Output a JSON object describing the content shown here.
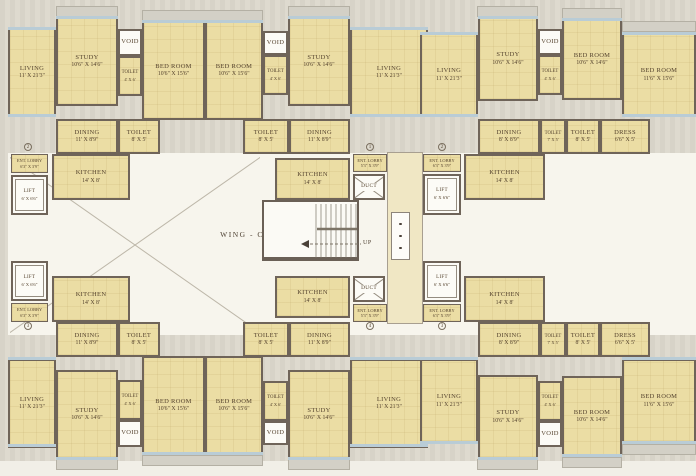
{
  "plan": {
    "wing_label": "WING - C",
    "stairs": {
      "up_label": "UP"
    },
    "colors": {
      "room_fill": "#ebdda4",
      "wall": "#6f6459",
      "window": "#b9ccd6",
      "open_area": "#f7f5ed",
      "background": "#d7d3c8",
      "text": "#55432e"
    },
    "flat_numbers": [
      {
        "value": "2",
        "x": 28,
        "y": 147
      },
      {
        "value": "1",
        "x": 370,
        "y": 147
      },
      {
        "value": "2",
        "x": 442,
        "y": 147
      },
      {
        "value": "3",
        "x": 28,
        "y": 326
      },
      {
        "value": "4",
        "x": 370,
        "y": 326
      },
      {
        "value": "3",
        "x": 442,
        "y": 326
      }
    ],
    "rooms": [
      {
        "kind": "hall",
        "x": 387,
        "y": 152,
        "w": 36,
        "h": 172
      },
      {
        "name": "LIVING",
        "dims": "11' X 21'3\"",
        "x": 8,
        "y": 28,
        "w": 48,
        "h": 89
      },
      {
        "name": "STUDY",
        "dims": "10'6\" X 14'6\"",
        "x": 56,
        "y": 17,
        "w": 62,
        "h": 89
      },
      {
        "name": "VOID",
        "x": 118,
        "y": 29,
        "w": 24,
        "h": 27,
        "kind": "shaft"
      },
      {
        "name": "TOILET",
        "dims": "4' X 6'",
        "x": 118,
        "y": 56,
        "w": 24,
        "h": 40
      },
      {
        "name": "BED ROOM",
        "dims": "10'6\" X 15'6\"",
        "x": 142,
        "y": 21,
        "w": 63,
        "h": 99
      },
      {
        "name": "BED ROOM",
        "dims": "10'6\" X 15'6\"",
        "x": 205,
        "y": 21,
        "w": 58,
        "h": 99
      },
      {
        "name": "VOID",
        "x": 263,
        "y": 31,
        "w": 25,
        "h": 24,
        "kind": "shaft"
      },
      {
        "name": "TOILET",
        "dims": "4' X 6'",
        "x": 263,
        "y": 55,
        "w": 25,
        "h": 40
      },
      {
        "name": "STUDY",
        "dims": "10'6\" X 14'6\"",
        "x": 288,
        "y": 17,
        "w": 62,
        "h": 89
      },
      {
        "name": "LIVING",
        "dims": "11' X 21'3\"",
        "x": 350,
        "y": 28,
        "w": 78,
        "h": 89
      },
      {
        "name": "LIVING",
        "dims": "11' X 21'3\"",
        "x": 420,
        "y": 33,
        "w": 58,
        "h": 84
      },
      {
        "name": "STUDY",
        "dims": "10'6\" X 14'6\"",
        "x": 478,
        "y": 17,
        "w": 60,
        "h": 84
      },
      {
        "name": "VOID",
        "x": 538,
        "y": 29,
        "w": 24,
        "h": 26,
        "kind": "shaft"
      },
      {
        "name": "TOILET",
        "dims": "4' X 6'",
        "x": 538,
        "y": 55,
        "w": 24,
        "h": 40
      },
      {
        "name": "BED ROOM",
        "dims": "10'6\" X 14'6\"",
        "x": 562,
        "y": 19,
        "w": 60,
        "h": 81
      },
      {
        "name": "BED ROOM",
        "dims": "11'6\" X 15'6\"",
        "x": 622,
        "y": 33,
        "w": 74,
        "h": 84
      },
      {
        "name": "DINING",
        "dims": "11' X 8'9\"",
        "x": 56,
        "y": 119,
        "w": 62,
        "h": 35
      },
      {
        "name": "TOILET",
        "dims": "8' X 5'",
        "x": 118,
        "y": 119,
        "w": 42,
        "h": 35
      },
      {
        "name": "TOILET",
        "dims": "8' X 5'",
        "x": 243,
        "y": 119,
        "w": 46,
        "h": 35
      },
      {
        "name": "DINING",
        "dims": "11' X 8'9\"",
        "x": 289,
        "y": 119,
        "w": 61,
        "h": 35
      },
      {
        "name": "DINING",
        "dims": "8' X 8'9\"",
        "x": 478,
        "y": 119,
        "w": 62,
        "h": 35
      },
      {
        "name": "TOILET",
        "dims": "7' X 5'",
        "x": 540,
        "y": 119,
        "w": 26,
        "h": 35
      },
      {
        "name": "TOILET",
        "dims": "8' X 5'",
        "x": 566,
        "y": 119,
        "w": 34,
        "h": 35
      },
      {
        "name": "DRESS",
        "dims": "6'6\" X 5'",
        "x": 600,
        "y": 119,
        "w": 50,
        "h": 35
      },
      {
        "name": "ENT. LOBBY",
        "dims": "6'3\" X 3'9\"",
        "x": 11,
        "y": 154,
        "w": 37,
        "h": 19,
        "kind": "small"
      },
      {
        "name": "LIFT",
        "dims": "6' X 6'6\"",
        "x": 11,
        "y": 175,
        "w": 37,
        "h": 40,
        "kind": "lift"
      },
      {
        "name": "KITCHEN",
        "dims": "14' X 8'",
        "x": 52,
        "y": 154,
        "w": 78,
        "h": 46
      },
      {
        "name": "KITCHEN",
        "dims": "14' X 8'",
        "x": 275,
        "y": 158,
        "w": 75,
        "h": 42
      },
      {
        "name": "ENT. LOBBY",
        "dims": "5'3\" X 3'9\"",
        "x": 353,
        "y": 154,
        "w": 34,
        "h": 18,
        "kind": "small"
      },
      {
        "name": "DUCT",
        "x": 353,
        "y": 174,
        "w": 32,
        "h": 26,
        "kind": "duct"
      },
      {
        "name": "ENT. LOBBY",
        "dims": "6'3\" X 3'9\"",
        "x": 423,
        "y": 154,
        "w": 38,
        "h": 18,
        "kind": "small"
      },
      {
        "name": "LIFT",
        "dims": "6' X 6'6\"",
        "x": 423,
        "y": 174,
        "w": 38,
        "h": 41,
        "kind": "lift"
      },
      {
        "name": "KITCHEN",
        "dims": "14' X 8'",
        "x": 464,
        "y": 154,
        "w": 81,
        "h": 46
      },
      {
        "kind": "stair",
        "x": 262,
        "y": 200,
        "w": 97,
        "h": 61
      },
      {
        "kind": "dots",
        "x": 391,
        "y": 212,
        "w": 19,
        "h": 48
      },
      {
        "name": "LIFT",
        "dims": "6' X 6'6\"",
        "x": 11,
        "y": 261,
        "w": 37,
        "h": 40,
        "kind": "lift"
      },
      {
        "name": "ENT. LOBBY",
        "dims": "6'3\" X 3'9\"",
        "x": 11,
        "y": 303,
        "w": 37,
        "h": 19,
        "kind": "small"
      },
      {
        "name": "KITCHEN",
        "dims": "14' X 8'",
        "x": 52,
        "y": 276,
        "w": 78,
        "h": 46
      },
      {
        "name": "KITCHEN",
        "dims": "14' X 8'",
        "x": 275,
        "y": 276,
        "w": 75,
        "h": 42
      },
      {
        "name": "DUCT",
        "x": 353,
        "y": 276,
        "w": 32,
        "h": 26,
        "kind": "duct"
      },
      {
        "name": "ENT. LOBBY",
        "dims": "5'3\" X 3'9\"",
        "x": 353,
        "y": 304,
        "w": 34,
        "h": 18,
        "kind": "small"
      },
      {
        "name": "LIFT",
        "dims": "6' X 6'6\"",
        "x": 423,
        "y": 261,
        "w": 38,
        "h": 41,
        "kind": "lift"
      },
      {
        "name": "ENT. LOBBY",
        "dims": "6'3\" X 3'9\"",
        "x": 423,
        "y": 304,
        "w": 38,
        "h": 18,
        "kind": "small"
      },
      {
        "name": "KITCHEN",
        "dims": "14' X 8'",
        "x": 464,
        "y": 276,
        "w": 81,
        "h": 46
      },
      {
        "name": "DINING",
        "dims": "11' X 8'9\"",
        "x": 56,
        "y": 322,
        "w": 62,
        "h": 35
      },
      {
        "name": "TOILET",
        "dims": "8' X 5'",
        "x": 118,
        "y": 322,
        "w": 42,
        "h": 35
      },
      {
        "name": "TOILET",
        "dims": "8' X 5'",
        "x": 243,
        "y": 322,
        "w": 46,
        "h": 35
      },
      {
        "name": "DINING",
        "dims": "11' X 8'9\"",
        "x": 289,
        "y": 322,
        "w": 61,
        "h": 35
      },
      {
        "name": "DINING",
        "dims": "8' X 8'9\"",
        "x": 478,
        "y": 322,
        "w": 62,
        "h": 35
      },
      {
        "name": "TOILET",
        "dims": "7' X 5'",
        "x": 540,
        "y": 322,
        "w": 26,
        "h": 35
      },
      {
        "name": "TOILET",
        "dims": "8' X 5'",
        "x": 566,
        "y": 322,
        "w": 34,
        "h": 35
      },
      {
        "name": "DRESS",
        "dims": "6'6\" X 5'",
        "x": 600,
        "y": 322,
        "w": 50,
        "h": 35
      },
      {
        "name": "LIVING",
        "dims": "11' X 21'3\"",
        "x": 8,
        "y": 359,
        "w": 48,
        "h": 89
      },
      {
        "name": "STUDY",
        "dims": "10'6\" X 14'6\"",
        "x": 56,
        "y": 370,
        "w": 62,
        "h": 89
      },
      {
        "name": "TOILET",
        "dims": "4' X 6'",
        "x": 118,
        "y": 380,
        "w": 24,
        "h": 40
      },
      {
        "name": "VOID",
        "x": 118,
        "y": 420,
        "w": 24,
        "h": 27,
        "kind": "shaft"
      },
      {
        "name": "BED ROOM",
        "dims": "10'6\" X 15'6\"",
        "x": 142,
        "y": 356,
        "w": 63,
        "h": 99
      },
      {
        "name": "BED ROOM",
        "dims": "10'6\" X 15'6\"",
        "x": 205,
        "y": 356,
        "w": 58,
        "h": 99
      },
      {
        "name": "TOILET",
        "dims": "4' X 6'",
        "x": 263,
        "y": 381,
        "w": 25,
        "h": 40
      },
      {
        "name": "VOID",
        "x": 263,
        "y": 421,
        "w": 25,
        "h": 24,
        "kind": "shaft"
      },
      {
        "name": "STUDY",
        "dims": "10'6\" X 14'6\"",
        "x": 288,
        "y": 370,
        "w": 62,
        "h": 89
      },
      {
        "name": "LIVING",
        "dims": "11' X 21'3\"",
        "x": 350,
        "y": 359,
        "w": 78,
        "h": 89
      },
      {
        "name": "LIVING",
        "dims": "11' X 21'3\"",
        "x": 420,
        "y": 359,
        "w": 58,
        "h": 84
      },
      {
        "name": "STUDY",
        "dims": "10'6\" X 14'6\"",
        "x": 478,
        "y": 375,
        "w": 60,
        "h": 84
      },
      {
        "name": "TOILET",
        "dims": "4' X 6'",
        "x": 538,
        "y": 381,
        "w": 24,
        "h": 40
      },
      {
        "name": "VOID",
        "x": 538,
        "y": 421,
        "w": 24,
        "h": 26,
        "kind": "shaft"
      },
      {
        "name": "BED ROOM",
        "dims": "10'6\" X 14'6\"",
        "x": 562,
        "y": 376,
        "w": 60,
        "h": 81
      },
      {
        "name": "BED ROOM",
        "dims": "11'6\" X 15'6\"",
        "x": 622,
        "y": 359,
        "w": 74,
        "h": 84
      }
    ]
  }
}
